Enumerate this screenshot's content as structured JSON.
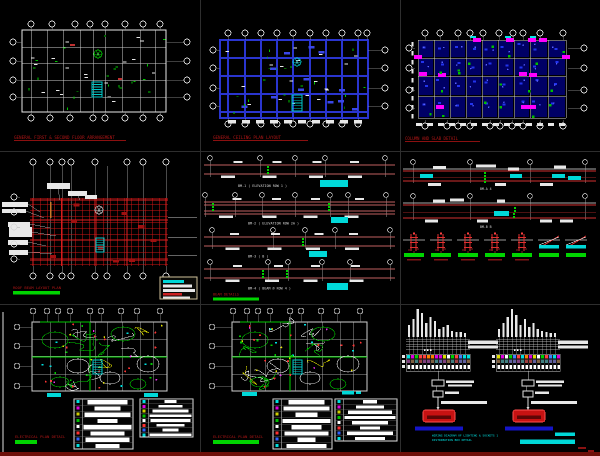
{
  "colors": {
    "background": "#000000",
    "title_red": "#b01616",
    "bright_green": "#00d400",
    "cyan": "#00e5e5",
    "wall_blue": "#2a35cf",
    "column_magenta": "#ff00ff",
    "beam_red": "#c06060",
    "footer_strip": "#6e100a"
  },
  "sheets": {
    "p1": {
      "title": "GENERAL FIRST & SECOND FLOOR ARRANGEMENT"
    },
    "p2": {
      "title": "GENERAL CEILING PLAN LAYOUT"
    },
    "p3": {
      "title": "COLUMN AND SLAB DETAIL"
    },
    "p4": {
      "title": "ROOF BEAM LAYOUT PLAN"
    },
    "p5": {
      "title": "BEAM DETAILS",
      "captions": [
        "BM-1 ( ELEVATION ROW 1 )",
        "BM-2 ( ELEVATION ROW 2A )",
        "BM-3  ( B )",
        "BM-4 ( BEAM @ ROW 4 )"
      ]
    },
    "p6": {
      "captions": [
        "BM-A  4",
        "BM-B  B"
      ]
    },
    "p7": {
      "title": "ELECTRICAL PLAN  DETAIL"
    },
    "p8": {
      "title": "ELECTRICAL PLAN  DETAIL"
    },
    "p9": {
      "notes": [
        "WIRING DIAGRAM OF LIGHTING & SOCKETS 1",
        "DISTRIBUTION BOX DETAIL"
      ],
      "riser_bars_left": [
        12,
        18,
        28,
        24,
        14,
        20,
        16,
        8,
        10,
        12,
        6,
        5,
        5,
        4
      ],
      "riser_bars_right": [
        8,
        14,
        20,
        28,
        22,
        12,
        18,
        10,
        14,
        8,
        6,
        5,
        4,
        4
      ]
    }
  }
}
